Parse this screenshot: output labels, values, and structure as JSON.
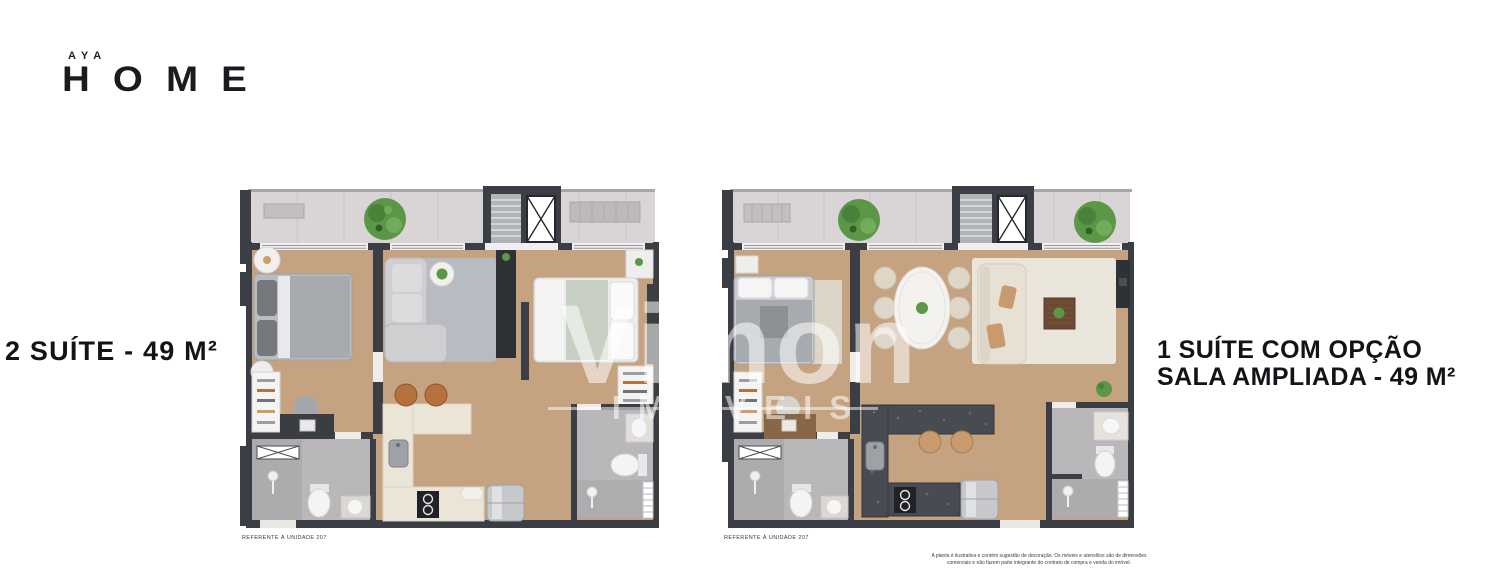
{
  "logo": {
    "top": "AYA",
    "main": "HOME"
  },
  "plans": {
    "left": {
      "title": "2 SUÍTE - 49 M²",
      "caption": "REFERENTE À UNIDADE 207"
    },
    "right": {
      "title_line1": "1 SUÍTE COM OPÇÃO",
      "title_line2": "SALA AMPLIADA - 49 M²",
      "caption": "REFERENTE À UNIDADE 207"
    }
  },
  "watermark": {
    "line1": "Vimon",
    "line2": "IMÓVEIS"
  },
  "disclaimer": {
    "line1": "A planta é ilustrativa e contém sugestão de decoração. Os móveis e utensílios são de dimensões",
    "line2": "comerciais e não fazem parte integrante do contrato de compra e venda do imóvel."
  },
  "colors": {
    "wall": "#3b3e44",
    "wood_floor": "#c6a380",
    "balcony_tile": "#d9d5d7",
    "bathroom_tile": "#bab7bb",
    "kitchen_counter_left": "#ebe5d8",
    "kitchen_counter_right": "#484b51",
    "text": "#141418",
    "plant_green": "#5b9746"
  }
}
